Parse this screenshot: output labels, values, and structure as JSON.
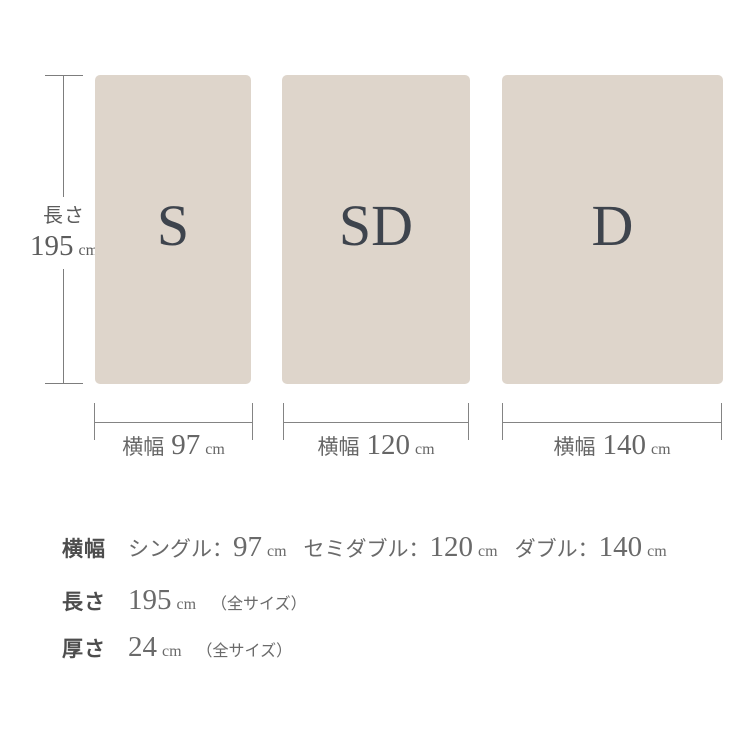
{
  "colors": {
    "background": "#ffffff",
    "mattress_fill": "#ded5cb",
    "size_letter": "#3e444d",
    "measure_line": "#7d7d7d",
    "measure_text": "#666666",
    "spec_label": "#4d4d4d",
    "spec_value": "#6a6a6a"
  },
  "diagram": {
    "length": {
      "label": "長さ",
      "value": "195",
      "unit": "cm"
    },
    "sizes": [
      {
        "code": "S",
        "width_label": "横幅",
        "width_value": "97",
        "unit": "cm"
      },
      {
        "code": "SD",
        "width_label": "横幅",
        "width_value": "120",
        "unit": "cm"
      },
      {
        "code": "D",
        "width_label": "横幅",
        "width_value": "140",
        "unit": "cm"
      }
    ]
  },
  "specs": {
    "width": {
      "label": "横幅",
      "items": [
        {
          "name": "シングル：",
          "value": "97",
          "unit": "cm"
        },
        {
          "name": "セミダブル：",
          "value": "120",
          "unit": "cm"
        },
        {
          "name": "ダブル：",
          "value": "140",
          "unit": "cm"
        }
      ]
    },
    "length": {
      "label": "長さ",
      "value": "195",
      "unit": "cm",
      "note": "（全サイズ）"
    },
    "thickness": {
      "label": "厚さ",
      "value": "24",
      "unit": "cm",
      "note": "（全サイズ）"
    }
  }
}
